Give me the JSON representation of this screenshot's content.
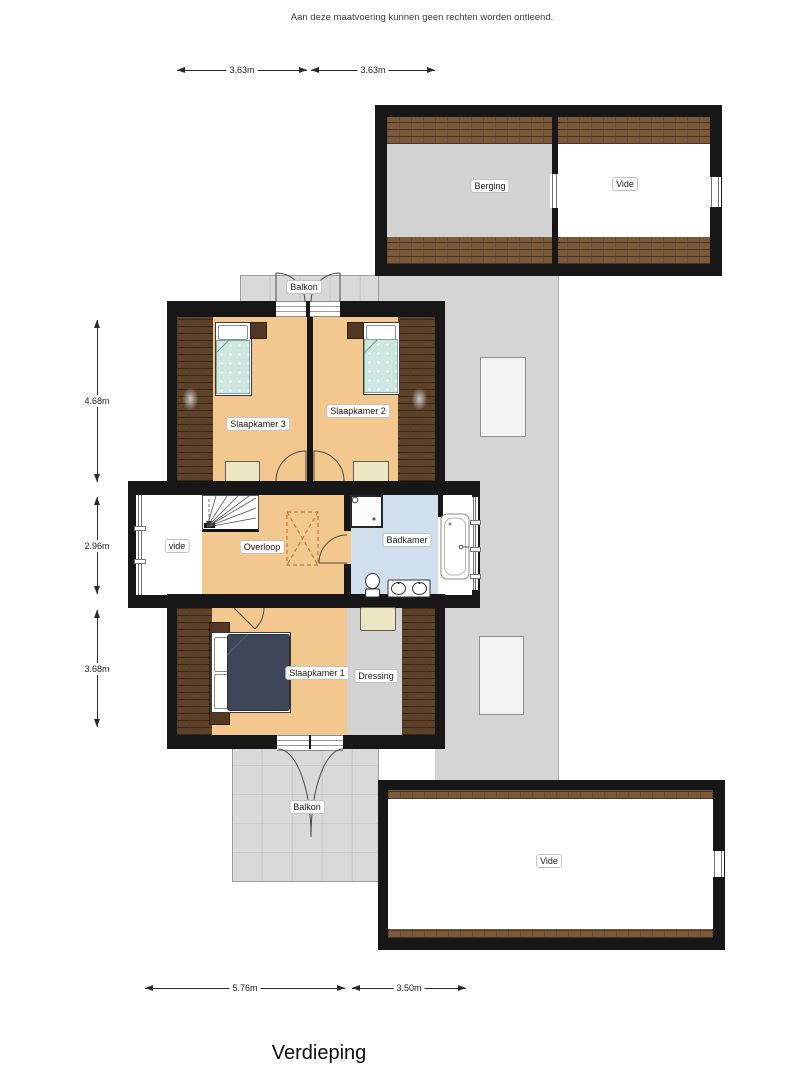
{
  "disclaimer": "Aan deze maatvoering kunnen geen rechten worden ontleend.",
  "title": "Verdieping",
  "rooms": {
    "berging": "Berging",
    "vide_top": "Vide",
    "balkon_top": "Balkon",
    "slaapkamer3": "Slaapkamer 3",
    "slaapkamer2": "Slaapkamer 2",
    "vide_mid": "vide",
    "overloop": "Overloop",
    "badkamer": "Badkamer",
    "slaapkamer1": "Slaapkamer 1",
    "dressing": "Dressing",
    "balkon_bottom": "Balkon",
    "vide_bottom": "Vide"
  },
  "dimensions": {
    "top": [
      "3.63m",
      "3.63m"
    ],
    "left": [
      "4.68m",
      "2.96m",
      "3.68m"
    ],
    "bottom": [
      "5.76m",
      "3.50m"
    ]
  },
  "colors": {
    "wall": "#171717",
    "floor_orange": "#f3c88f",
    "floor_bath_blue": "#cfdfee",
    "floor_gray": "#d3d3d3",
    "roof_gray": "#d5d5d5",
    "brick_brown": "#7b5a39",
    "brick_dark": "#5e4228",
    "bed_teal": "#cde7e0",
    "duvet_navy": "#3e4659",
    "furniture_cream": "#ece6c2"
  }
}
